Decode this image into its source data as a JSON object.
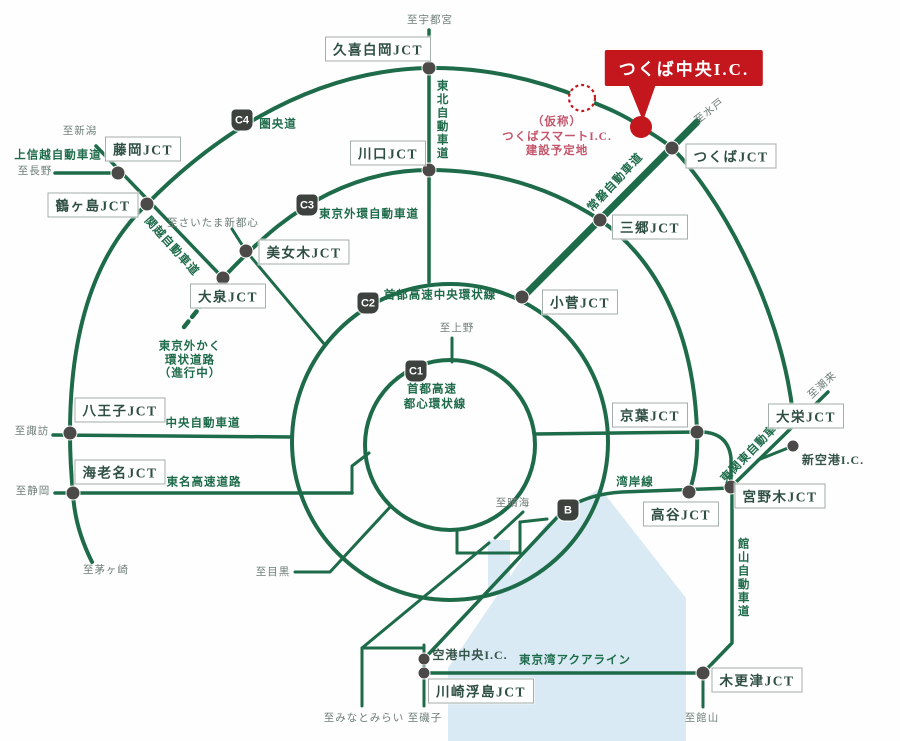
{
  "map": {
    "title": "つくば中央I.C. 広域道路ネットワーク図",
    "colors": {
      "road": "#1e6b4a",
      "node": "#4c4a48",
      "bay": "#d9eaf5",
      "red": "#c3161d",
      "red_text": "#c4566b",
      "dest_text": "#6e7d75",
      "box_text": "#2f4f43",
      "box_border": "#a3aeaa",
      "badge_bg": "#3d423f",
      "badge_text": "#ffffff"
    },
    "bay": {
      "points": "600,488 686,598 686,741 448,741 448,668 545,525",
      "strip": {
        "x": 488,
        "y": 540,
        "w": 22,
        "h": 52
      }
    },
    "roads": [
      {
        "name": "keno-expressway",
        "w": 4,
        "d": "M 92 562 C 80 538 74 515 73 493 C 71 473 70 453 70 433 C 70 330 95 253 147 204 C 200 150 300 70 429 68 C 485 67 538 80 582 98 C 605 107 625 115 641 127 C 652 134 663 140 672 148 C 715 190 780 300 793 414"
      },
      {
        "name": "gaikan-c3",
        "w": 4,
        "d": "M 223 278 C 240 260 258 242 278 226 C 320 193 370 170 429 170 C 500 170 556 191 600 220 C 655 258 694 330 697 432 C 698 456 695 476 689 492"
      },
      {
        "name": "tohoku-expressway",
        "w": 3.5,
        "d": "M 429 30 L 429 282"
      },
      {
        "name": "joban-expressway",
        "w": 7,
        "d": "M 523 297 L 697 122"
      },
      {
        "name": "joshinetsu-expressway",
        "w": 3.5,
        "d": "M 55 173 L 118 173"
      },
      {
        "name": "kanetsu-expressway",
        "w": 3.5,
        "d": "M 96 146 L 223 278"
      },
      {
        "name": "gaikaku-under-construction",
        "w": 4.5,
        "dash": "7 6",
        "d": "M 221 281 L 184 327"
      },
      {
        "name": "saitama-spur",
        "w": 3,
        "d": "M 232 229 L 246 251 L 325 345"
      },
      {
        "name": "chuo-expressway",
        "w": 3.5,
        "d": "M 53 435 L 292 437"
      },
      {
        "name": "tomei-expressway",
        "w": 3.5,
        "d": "M 55 493 L 352 493"
      },
      {
        "name": "shibuya-link",
        "w": 3,
        "d": "M 352 493 L 352 466 L 369 453"
      },
      {
        "name": "meguro-line",
        "w": 3,
        "d": "M 295 572 L 330 572 L 391 506"
      },
      {
        "name": "ueno-spur",
        "w": 3,
        "d": "M 452 338 L 452 362"
      },
      {
        "name": "c1-south-vertical",
        "w": 3,
        "d": "M 457 530 L 457 553"
      },
      {
        "name": "south-horizontal",
        "w": 3,
        "d": "M 457 553 L 520 553"
      },
      {
        "name": "south-vertical2",
        "w": 3,
        "d": "M 520 522 L 520 553"
      },
      {
        "name": "south-link",
        "w": 3,
        "d": "M 520 522 L 547 519"
      },
      {
        "name": "harumi-spur",
        "w": 3,
        "d": "M 495 538 L 523 512"
      },
      {
        "name": "wangan-line",
        "w": 3.5,
        "d": "M 731 488 L 622 492 Q 588 494 564 510 L 424 659"
      },
      {
        "name": "yokohane-line",
        "w": 3,
        "d": "M 362 648 L 489 543"
      },
      {
        "name": "haneda-horizontal",
        "w": 3,
        "d": "M 362 648 L 424 648"
      },
      {
        "name": "haneda-vertical-left",
        "w": 3,
        "d": "M 362 648 L 362 706"
      },
      {
        "name": "haneda-vertical-right",
        "w": 3,
        "d": "M 424 645 L 424 706"
      },
      {
        "name": "tokyo-bay-aqualine",
        "w": 3.5,
        "d": "M 424 673 L 703 673"
      },
      {
        "name": "keiyo-road",
        "w": 3.5,
        "d": "M 535 434 L 700 432 Q 728 432 731 458 L 731 487"
      },
      {
        "name": "tateyama-expressway",
        "w": 3.5,
        "d": "M 703 673 L 732 643 L 732 487"
      },
      {
        "name": "tateyama-south",
        "w": 3,
        "d": "M 703 673 L 703 707"
      },
      {
        "name": "higashi-kanto-expressway",
        "w": 3.5,
        "d": "M 731 487 L 828 392"
      },
      {
        "name": "shin-kuko-spur",
        "w": 3,
        "d": "M 758 460 L 793 446"
      }
    ],
    "circles": [
      {
        "name": "chuo-kanjo-c2",
        "cx": 450,
        "cy": 442,
        "r": 158,
        "w": 4
      },
      {
        "name": "toshin-kanjo-c1",
        "cx": 450,
        "cy": 445,
        "r": 85,
        "w": 4
      }
    ],
    "nodes": [
      {
        "name": "kuki-shiraoka",
        "x": 429,
        "y": 68,
        "r": 7
      },
      {
        "name": "kawaguchi",
        "x": 429,
        "y": 170,
        "r": 7
      },
      {
        "name": "fujioka",
        "x": 118,
        "y": 173,
        "r": 7
      },
      {
        "name": "tsurugashima",
        "x": 147,
        "y": 204,
        "r": 7
      },
      {
        "name": "bijogi",
        "x": 246,
        "y": 251,
        "r": 7
      },
      {
        "name": "oizumi",
        "x": 223,
        "y": 278,
        "r": 7
      },
      {
        "name": "hachioji",
        "x": 70,
        "y": 433,
        "r": 7
      },
      {
        "name": "ebina",
        "x": 73,
        "y": 493,
        "r": 7
      },
      {
        "name": "tsukuba",
        "x": 672,
        "y": 148,
        "r": 7
      },
      {
        "name": "misato",
        "x": 600,
        "y": 220,
        "r": 7
      },
      {
        "name": "kosuge",
        "x": 522,
        "y": 297,
        "r": 7
      },
      {
        "name": "keiyo",
        "x": 697,
        "y": 432,
        "r": 7
      },
      {
        "name": "koya",
        "x": 689,
        "y": 492,
        "r": 7
      },
      {
        "name": "miyanogi",
        "x": 731,
        "y": 487,
        "r": 7
      },
      {
        "name": "daiei",
        "x": 793,
        "y": 414,
        "r": 7
      },
      {
        "name": "shin-kuko",
        "x": 793,
        "y": 446,
        "r": 6
      },
      {
        "name": "kisarazu",
        "x": 703,
        "y": 673,
        "r": 7
      },
      {
        "name": "kawasaki-ukishima",
        "x": 424,
        "y": 673,
        "r": 6
      },
      {
        "name": "kuko-chuo",
        "x": 424,
        "y": 659,
        "r": 6
      }
    ],
    "badges": [
      {
        "name": "badge-c4",
        "label": "C4",
        "x": 242,
        "y": 120
      },
      {
        "name": "badge-c3",
        "label": "C3",
        "x": 307,
        "y": 205
      },
      {
        "name": "badge-c2",
        "label": "C2",
        "x": 368,
        "y": 303
      },
      {
        "name": "badge-c1",
        "label": "C1",
        "x": 416,
        "y": 371
      },
      {
        "name": "badge-b",
        "label": "B",
        "x": 568,
        "y": 510
      }
    ],
    "jct_boxes": [
      {
        "name": "kuki-shiraoka-jct",
        "label": "久喜白岡JCT",
        "x": 378,
        "y": 49
      },
      {
        "name": "kawaguchi-jct",
        "label": "川口JCT",
        "x": 388,
        "y": 153
      },
      {
        "name": "fujioka-jct",
        "label": "藤岡JCT",
        "x": 143,
        "y": 149
      },
      {
        "name": "tsurugashima-jct",
        "label": "鶴ヶ島JCT",
        "x": 93,
        "y": 205
      },
      {
        "name": "bijogi-jct",
        "label": "美女木JCT",
        "x": 304,
        "y": 252
      },
      {
        "name": "oizumi-jct",
        "label": "大泉JCT",
        "x": 228,
        "y": 296
      },
      {
        "name": "hachioji-jct",
        "label": "八王子JCT",
        "x": 120,
        "y": 410
      },
      {
        "name": "ebina-jct",
        "label": "海老名JCT",
        "x": 120,
        "y": 472
      },
      {
        "name": "tsukuba-jct",
        "label": "つくばJCT",
        "x": 731,
        "y": 156
      },
      {
        "name": "misato-jct",
        "label": "三郷JCT",
        "x": 650,
        "y": 227
      },
      {
        "name": "kosuge-jct",
        "label": "小菅JCT",
        "x": 580,
        "y": 302
      },
      {
        "name": "keiyo-jct",
        "label": "京葉JCT",
        "x": 650,
        "y": 415
      },
      {
        "name": "koya-jct",
        "label": "高谷JCT",
        "x": 681,
        "y": 514
      },
      {
        "name": "miyanogi-jct",
        "label": "宮野木JCT",
        "x": 780,
        "y": 496
      },
      {
        "name": "daiei-jct",
        "label": "大栄JCT",
        "x": 806,
        "y": 416
      },
      {
        "name": "kisarazu-jct",
        "label": "木更津JCT",
        "x": 757,
        "y": 680
      },
      {
        "name": "kawasaki-ukishima-jct",
        "label": "川崎浮島JCT",
        "x": 481,
        "y": 691
      }
    ],
    "labels": [
      {
        "name": "to-utsunomiya",
        "text": "至宇都宮",
        "x": 430,
        "y": 21,
        "cls": "dest"
      },
      {
        "name": "tohoku-expwy-label",
        "text": "東北自動車道",
        "x": 441,
        "y": 120,
        "cls": "road vert"
      },
      {
        "name": "kenodo-label",
        "text": "圏央道",
        "x": 278,
        "y": 125,
        "cls": "road"
      },
      {
        "name": "to-niigata",
        "text": "至新潟",
        "x": 80,
        "y": 132,
        "cls": "dest"
      },
      {
        "name": "joshinetsu-label",
        "text": "上信越自動車道",
        "x": 58,
        "y": 156,
        "cls": "road"
      },
      {
        "name": "to-nagano",
        "text": "至長野",
        "x": 35,
        "y": 172,
        "cls": "dest"
      },
      {
        "name": "kanetsu-label",
        "text": "関越自動車道",
        "x": 171,
        "y": 247,
        "cls": "road",
        "rot": 48
      },
      {
        "name": "to-saitama-shintoshin",
        "text": "至さいたま新都心",
        "x": 213,
        "y": 224,
        "cls": "dest"
      },
      {
        "name": "gaikan-label",
        "text": "東京外環自動車道",
        "x": 369,
        "y": 215,
        "cls": "road"
      },
      {
        "name": "gaikaku-label-1",
        "text": "東京外かく",
        "x": 190,
        "y": 347,
        "cls": "road"
      },
      {
        "name": "gaikaku-label-2",
        "text": "環状道路",
        "x": 190,
        "y": 361,
        "cls": "road"
      },
      {
        "name": "gaikaku-label-3",
        "text": "（進行中）",
        "x": 190,
        "y": 374,
        "cls": "road"
      },
      {
        "name": "c2-label",
        "text": "首都高速中央環状線",
        "x": 440,
        "y": 296,
        "cls": "road"
      },
      {
        "name": "to-ueno",
        "text": "至上野",
        "x": 457,
        "y": 329,
        "cls": "dest"
      },
      {
        "name": "c1-label-1",
        "text": "首都高速",
        "x": 432,
        "y": 390,
        "cls": "road"
      },
      {
        "name": "c1-label-2",
        "text": "都心環状線",
        "x": 435,
        "y": 405,
        "cls": "road"
      },
      {
        "name": "joban-label",
        "text": "常磐自動車道",
        "x": 616,
        "y": 183,
        "cls": "road",
        "rot": -47
      },
      {
        "name": "to-mito",
        "text": "至水戸",
        "x": 710,
        "y": 112,
        "cls": "dest",
        "rot": -38
      },
      {
        "name": "chuo-expwy-label",
        "text": "中央自動車道",
        "x": 203,
        "y": 424,
        "cls": "road"
      },
      {
        "name": "to-suwa",
        "text": "至諏訪",
        "x": 32,
        "y": 432,
        "cls": "dest"
      },
      {
        "name": "tomei-label",
        "text": "東名高速道路",
        "x": 204,
        "y": 483,
        "cls": "road"
      },
      {
        "name": "to-shizuoka",
        "text": "至静岡",
        "x": 33,
        "y": 492,
        "cls": "dest"
      },
      {
        "name": "to-chigasaki",
        "text": "至茅ヶ崎",
        "x": 106,
        "y": 571,
        "cls": "dest"
      },
      {
        "name": "to-meguro",
        "text": "至目黒",
        "x": 273,
        "y": 573,
        "cls": "dest"
      },
      {
        "name": "wangan-label",
        "text": "湾岸線",
        "x": 635,
        "y": 483,
        "cls": "road"
      },
      {
        "name": "to-harumi",
        "text": "至晴海",
        "x": 513,
        "y": 504,
        "cls": "dest"
      },
      {
        "name": "higashikanto-label",
        "text": "東関東自動車道",
        "x": 754,
        "y": 450,
        "cls": "road",
        "rot": -46
      },
      {
        "name": "to-itako",
        "text": "至潮来",
        "x": 823,
        "y": 386,
        "cls": "dest",
        "rot": -42
      },
      {
        "name": "shin-kuko-ic-label",
        "text": "新空港I.C.",
        "x": 833,
        "y": 461,
        "cls": "ic"
      },
      {
        "name": "tateyama-label",
        "text": "館山自動車道",
        "x": 742,
        "y": 578,
        "cls": "road vert"
      },
      {
        "name": "kuko-chuo-ic-label",
        "text": "空港中央I.C.",
        "x": 470,
        "y": 656,
        "cls": "ic"
      },
      {
        "name": "aqualine-label",
        "text": "東京湾アクアライン",
        "x": 575,
        "y": 661,
        "cls": "road"
      },
      {
        "name": "to-tateyama",
        "text": "至館山",
        "x": 702,
        "y": 719,
        "cls": "dest"
      },
      {
        "name": "to-minatomirai",
        "text": "至みなとみらい",
        "x": 364,
        "y": 719,
        "cls": "dest"
      },
      {
        "name": "to-isogo",
        "text": "至磯子",
        "x": 425,
        "y": 719,
        "cls": "dest"
      }
    ],
    "highlight": {
      "callout_label": "つくば中央I.C.",
      "callout_x": 684,
      "callout_y": 68,
      "tail_points": "628,84 656,84 643,121",
      "dot": {
        "x": 641,
        "y": 127,
        "r": 11
      },
      "planned_circle": {
        "x": 582,
        "y": 98,
        "r": 13
      },
      "planned_site_lines": [
        "（仮称）",
        "つくばスマートI.C.",
        "建設予定地"
      ],
      "planned_site_x": 557,
      "planned_site_ys": [
        121,
        136,
        150
      ]
    }
  }
}
